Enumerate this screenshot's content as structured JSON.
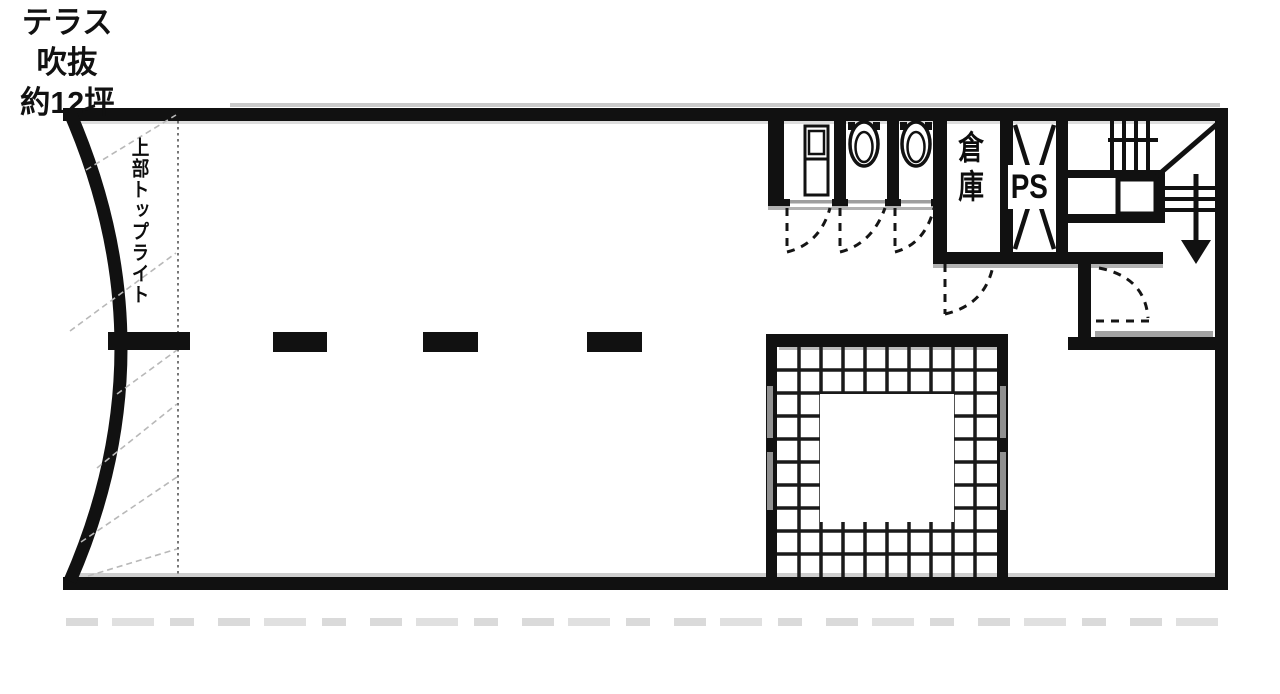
{
  "plan": {
    "type": "architectural-floor-plan",
    "labels": {
      "skylight": "上部トップライト",
      "storage": "倉庫",
      "pipe_space": "PS",
      "terrace_line1": "テラス",
      "terrace_line2": "吹抜",
      "terrace_line3": "約12坪"
    },
    "features": {
      "toilet_stalls": 3,
      "toilet_bowls": 2,
      "washstand_units": 1,
      "door_swings": 5,
      "stair_direction": "down"
    },
    "colors": {
      "wall": "#111111",
      "background": "#ffffff",
      "shadow": "#9e9e9e",
      "hatch": "#b8b8b8",
      "grid": "#1a1a1a"
    }
  }
}
